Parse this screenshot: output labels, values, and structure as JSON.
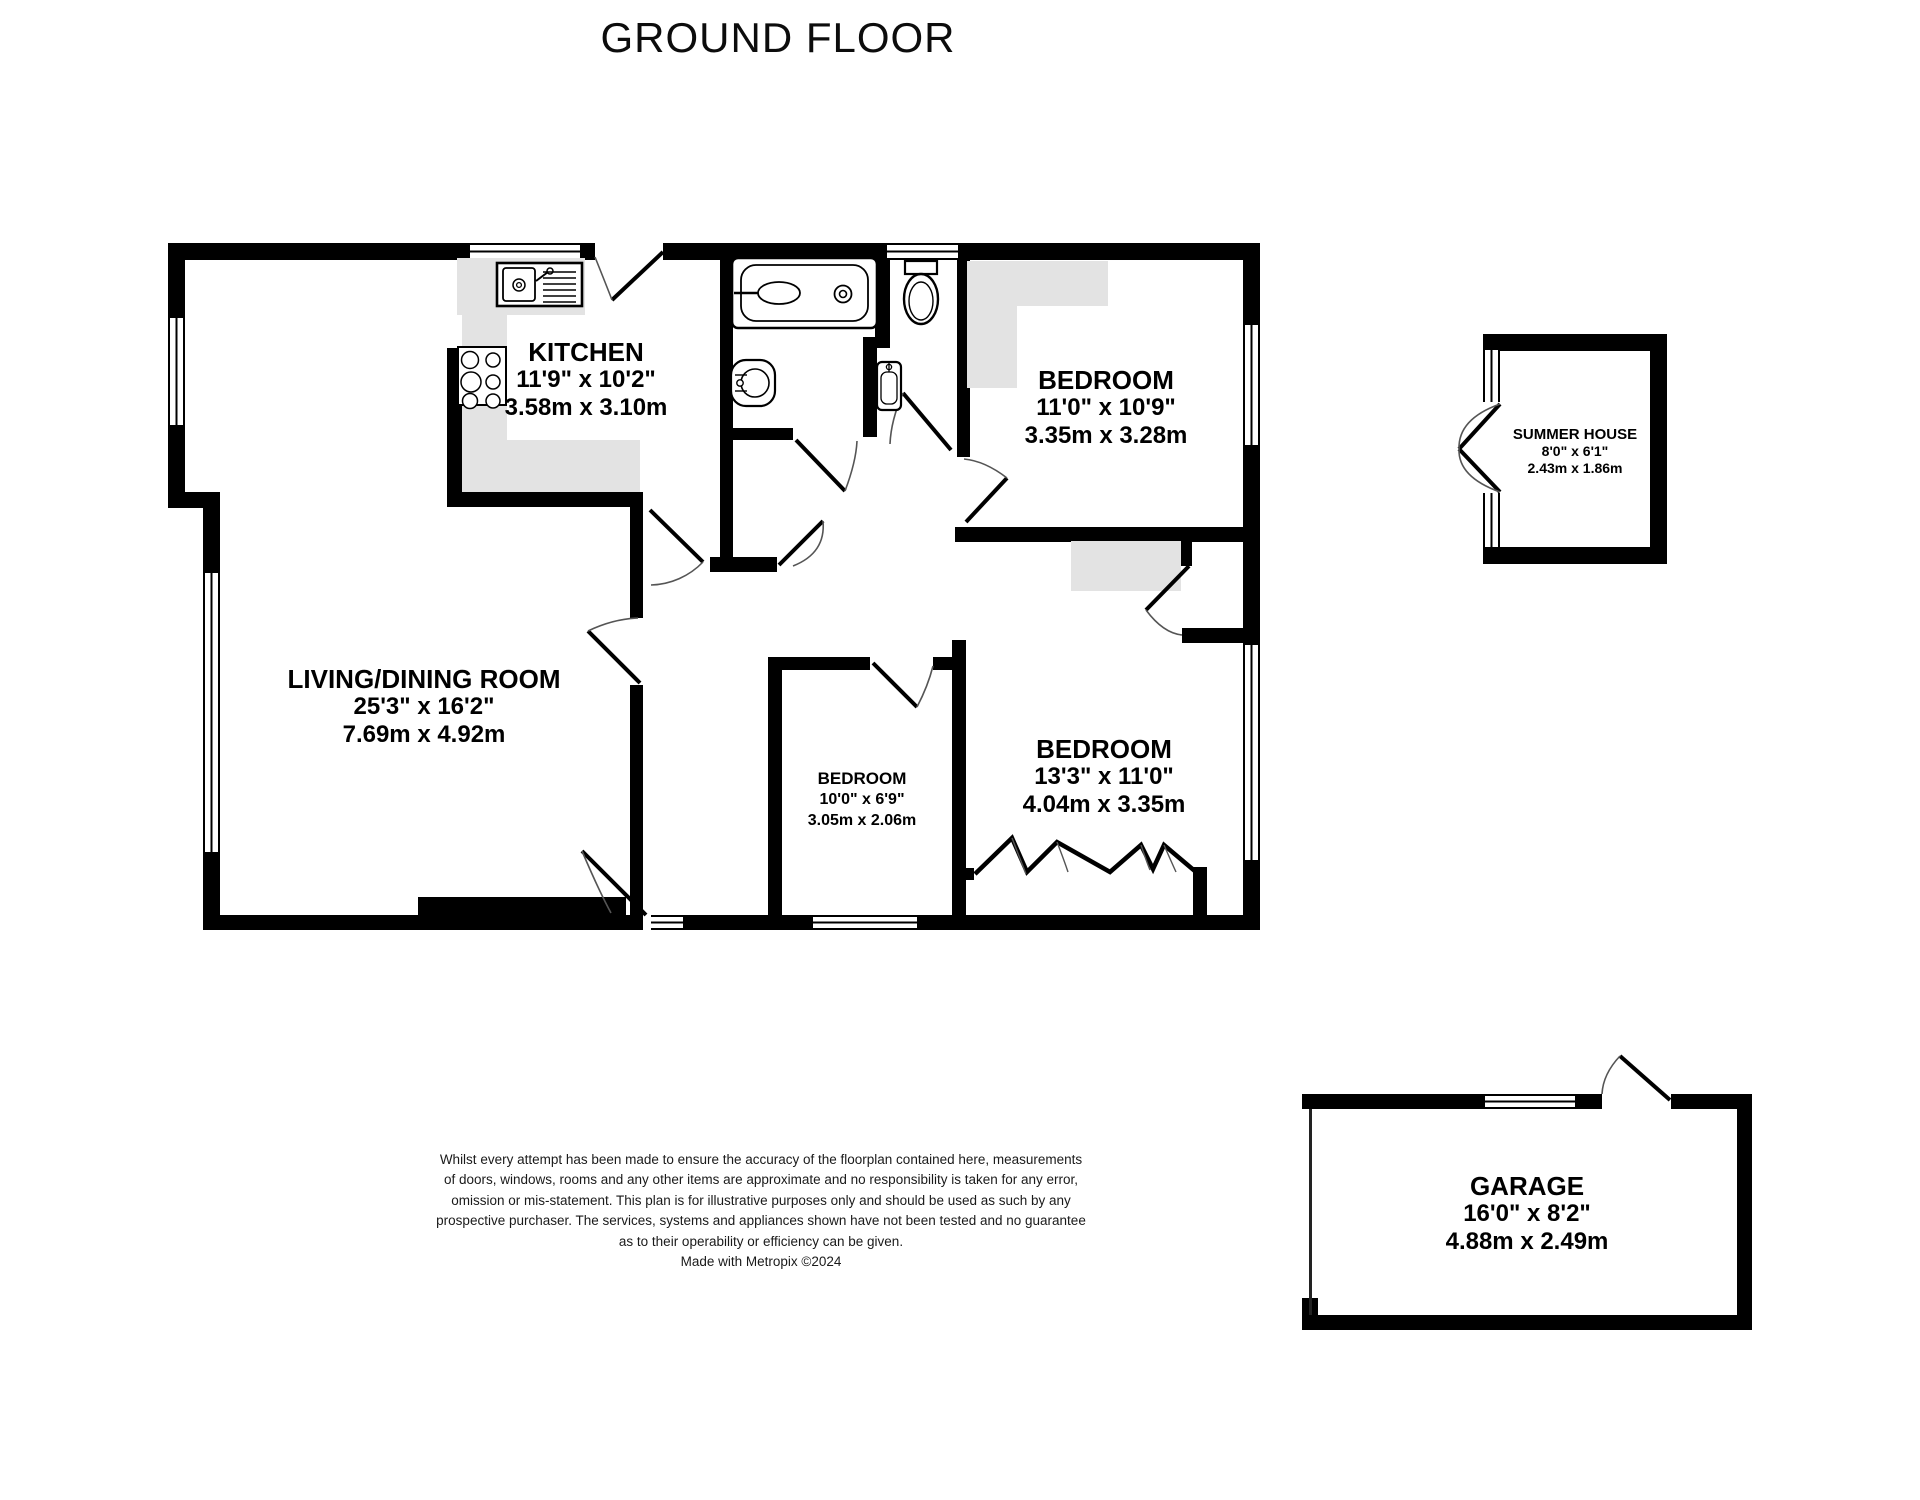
{
  "title": "GROUND FLOOR",
  "rooms": [
    {
      "name": "KITCHEN",
      "imperial": "11'9\"  x 10'2\"",
      "metric": "3.58m  x 3.10m"
    },
    {
      "name": "LIVING/DINING ROOM",
      "imperial": "25'3\"  x 16'2\"",
      "metric": "7.69m  x 4.92m"
    },
    {
      "name": "BEDROOM",
      "imperial": "11'0\"  x 10'9\"",
      "metric": "3.35m  x 3.28m"
    },
    {
      "name": "BEDROOM",
      "imperial": "10'0\"  x 6'9\"",
      "metric": "3.05m  x 2.06m"
    },
    {
      "name": "BEDROOM",
      "imperial": "13'3\"  x 11'0\"",
      "metric": "4.04m  x 3.35m"
    },
    {
      "name": "SUMMER HOUSE",
      "imperial": "8'0\"  x 6'1\"",
      "metric": "2.43m  x 1.86m"
    },
    {
      "name": "GARAGE",
      "imperial": "16'0\"  x 8'2\"",
      "metric": "4.88m  x 2.49m"
    }
  ],
  "disclaimer": {
    "lines": [
      "Whilst every attempt has been made to ensure the accuracy of the floorplan contained here, measurements",
      "of doors, windows, rooms and any other items are approximate and no responsibility is taken for any error,",
      "omission or mis-statement. This plan is for illustrative purposes only and should be used as such by any",
      "prospective purchaser. The services, systems and appliances shown have not been tested and no guarantee",
      "as to their operability or efficiency can be given.",
      "Made with Metropix ©2024"
    ]
  },
  "colors": {
    "wall": "#000000",
    "counter_gray": "#e3e3e3",
    "text": "#111111"
  }
}
